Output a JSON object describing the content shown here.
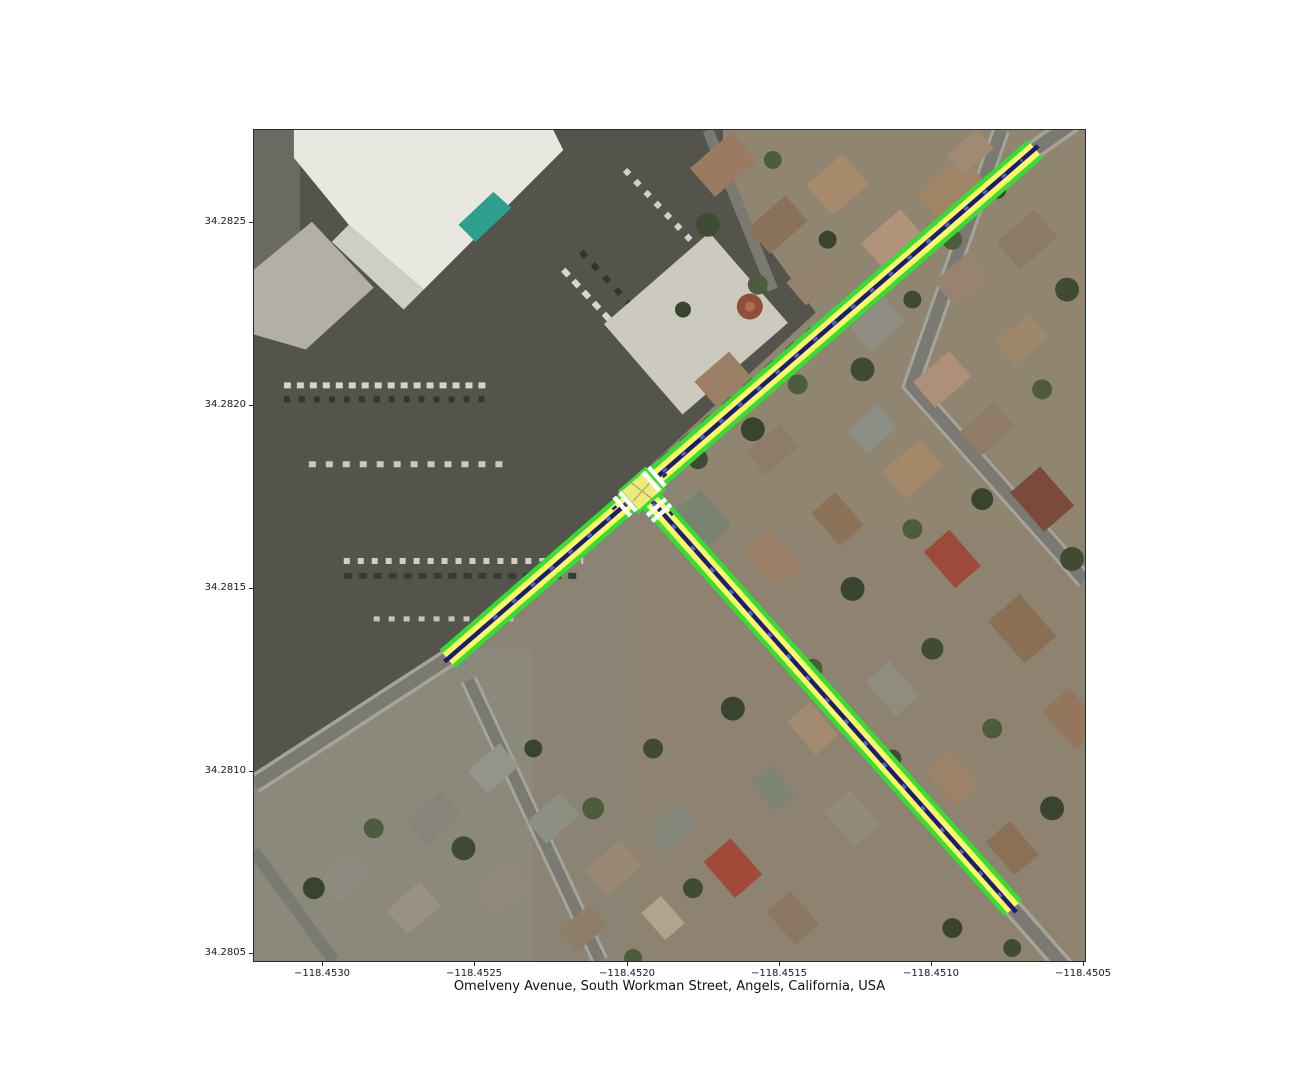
{
  "figure": {
    "xlabel": "Omelveny Avenue, South Workman Street, Angels, California, USA",
    "background": "#ffffff"
  },
  "axes": {
    "x_ticks": [
      "−118.4530",
      "−118.4525",
      "−118.4520",
      "−118.4515",
      "−118.4510",
      "−118.4505"
    ],
    "y_ticks": [
      "34.2825",
      "34.2820",
      "34.2815",
      "34.2810",
      "34.2805"
    ],
    "x_range": [
      -118.45323,
      -118.45048
    ],
    "y_range": [
      34.28048,
      34.28275
    ]
  },
  "map": {
    "location": "Omelveny Avenue, South Workman Street, Angels, California, USA",
    "imagery": "aerial-photo",
    "roads": [
      {
        "name": "Omelveny Avenue",
        "from": {
          "lon": -118.4526,
          "lat": 34.2813
        },
        "to": {
          "lon": -118.45066,
          "lat": 34.2827
        }
      },
      {
        "name": "South Workman Street",
        "from": {
          "lon": -118.45195,
          "lat": 34.28176
        },
        "to": {
          "lon": -118.45073,
          "lat": 34.28062
        }
      }
    ],
    "junction": {
      "lon": -118.45192,
      "lat": 34.28177,
      "crosswalk_count": 3
    },
    "overlay_colors": {
      "sidewalk_green": "#35dd35",
      "lane_yellow": "#fbf964",
      "center_navy": "#1c1c74",
      "vehicle_blue": "#4f62d8",
      "crosswalk_white": "#ffffff",
      "junction_yellow": "#eeea7d",
      "junction_border_green": "#35dd35"
    }
  }
}
